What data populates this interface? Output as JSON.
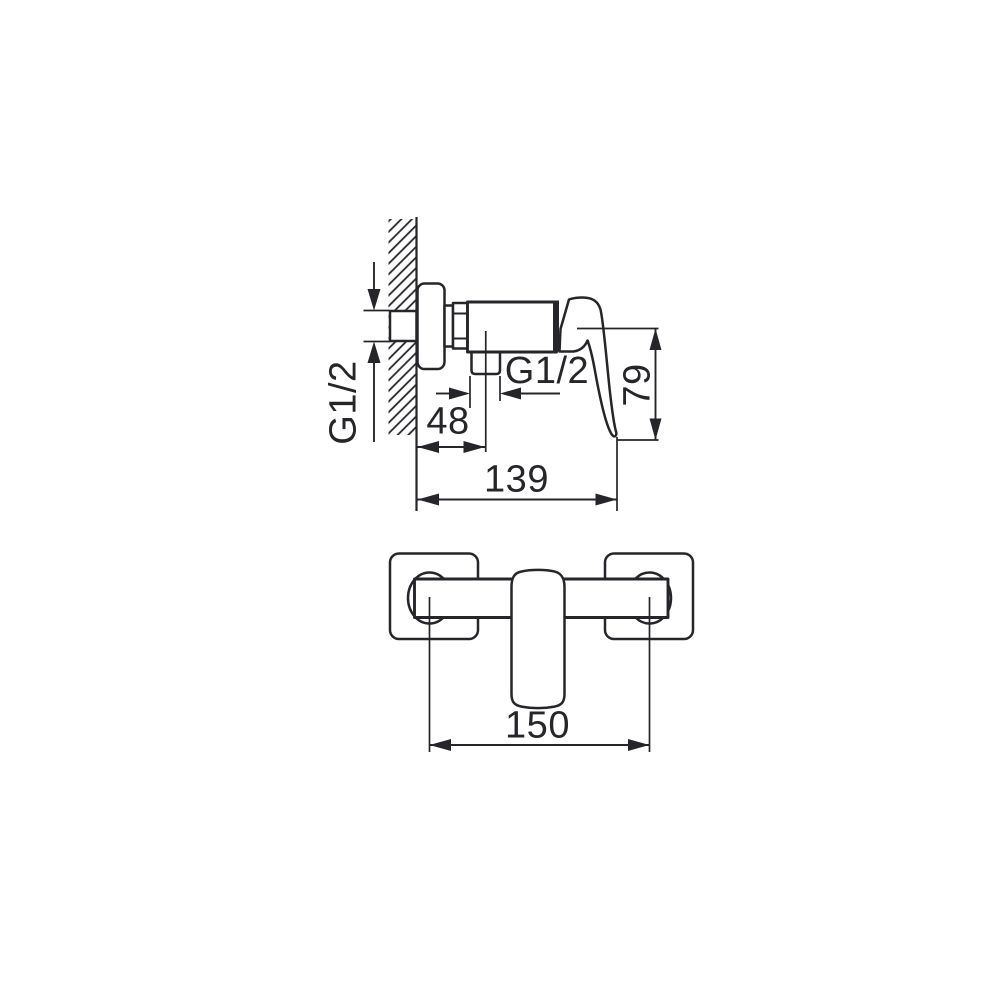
{
  "colors": {
    "ink": "#26262a",
    "background": "#ffffff"
  },
  "side_view": {
    "wall_thread_label": "G1/2",
    "outlet_thread_label": "G1/2",
    "wall_to_outlet_center": "48",
    "overall_depth": "139",
    "handle_height": "79"
  },
  "front_view": {
    "connection_spacing": "150"
  }
}
